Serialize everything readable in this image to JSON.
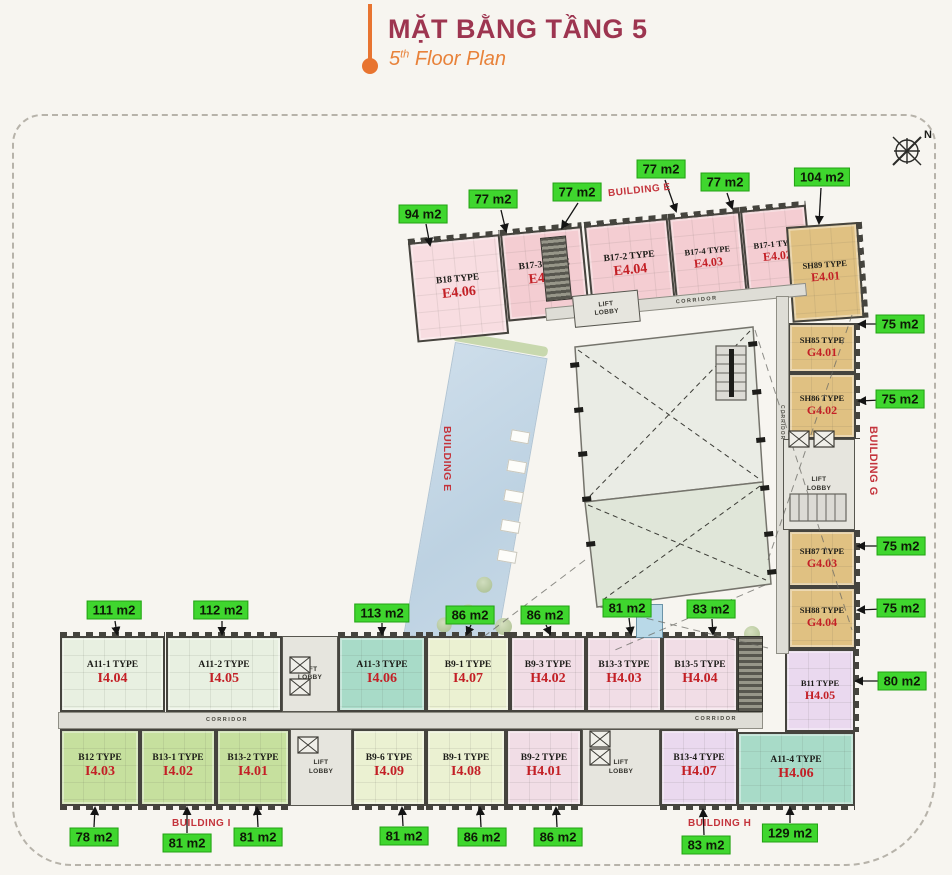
{
  "header": {
    "title": "MẶT BẰNG TẦNG 5",
    "subtitle_number": "5",
    "subtitle_ordinal": "th",
    "subtitle_text": " Floor Plan"
  },
  "compass": {
    "north_label": "N"
  },
  "labels": {
    "corridor": "CORRIDOR",
    "lift_lobby": "LIFT LOBBY",
    "building_e": "BUILDING E",
    "building_g": "BUILDING G",
    "building_h": "BUILDING H",
    "building_i": "BUILDING I"
  },
  "palette": {
    "pink": "#f4cdd2",
    "pink_light": "#f8dde1",
    "tan": "#e0c182",
    "pale_green": "#e8f0e1",
    "teal": "#a8dbc8",
    "sage": "#ebf1d2",
    "lime": "#c6e09e",
    "lavender": "#f1dde6",
    "purple": "#ead9ef",
    "badge_green": "#3fd62e",
    "unit_code_red": "#c32026",
    "building_label_red": "#c4343c",
    "title_maroon": "#9d3550",
    "accent_orange": "#e87430"
  },
  "units": [
    {
      "id": "E4.06",
      "name": "B18 TYPE",
      "code": "E4.06",
      "area": "94 m2"
    },
    {
      "id": "E4.05",
      "name": "B17-3 TYPE",
      "code": "E4.05",
      "area": "77 m2"
    },
    {
      "id": "E4.04",
      "name": "B17-2 TYPE",
      "code": "E4.04",
      "area": "77 m2"
    },
    {
      "id": "E4.03",
      "name": "B17-4 TYPE",
      "code": "E4.03",
      "area": "77 m2"
    },
    {
      "id": "E4.02",
      "name": "B17-1 TYPE",
      "code": "E4.02",
      "area": "77 m2"
    },
    {
      "id": "E4.01",
      "name": "SH89 TYPE",
      "code": "E4.01",
      "area": "104 m2"
    },
    {
      "id": "G4.01",
      "name": "SH85 TYPE",
      "code": "G4.01",
      "area": "75 m2"
    },
    {
      "id": "G4.02",
      "name": "SH86 TYPE",
      "code": "G4.02",
      "area": "75 m2"
    },
    {
      "id": "G4.03",
      "name": "SH87 TYPE",
      "code": "G4.03",
      "area": "75 m2"
    },
    {
      "id": "G4.04",
      "name": "SH88 TYPE",
      "code": "G4.04",
      "area": "75 m2"
    },
    {
      "id": "H4.05",
      "name": "B11 TYPE",
      "code": "H4.05",
      "area": "80 m2"
    },
    {
      "id": "H4.06",
      "name": "A11-4 TYPE",
      "code": "H4.06",
      "area": "129 m2"
    },
    {
      "id": "I4.04",
      "name": "A11-1 TYPE",
      "code": "I4.04",
      "area": "111 m2"
    },
    {
      "id": "I4.05",
      "name": "A11-2 TYPE",
      "code": "I4.05",
      "area": "112 m2"
    },
    {
      "id": "I4.06",
      "name": "A11-3 TYPE",
      "code": "I4.06",
      "area": "113 m2"
    },
    {
      "id": "I4.07",
      "name": "B9-1 TYPE",
      "code": "I4.07",
      "area": "86 m2"
    },
    {
      "id": "H4.02",
      "name": "B9-3 TYPE",
      "code": "H4.02",
      "area": "86 m2"
    },
    {
      "id": "H4.03",
      "name": "B13-3 TYPE",
      "code": "H4.03",
      "area": "81 m2"
    },
    {
      "id": "H4.04",
      "name": "B13-5 TYPE",
      "code": "H4.04",
      "area": "83 m2"
    },
    {
      "id": "I4.03",
      "name": "B12 TYPE",
      "code": "I4.03",
      "area": "78 m2"
    },
    {
      "id": "I4.02",
      "name": "B13-1 TYPE",
      "code": "I4.02",
      "area": "81 m2"
    },
    {
      "id": "I4.01",
      "name": "B13-2 TYPE",
      "code": "I4.01",
      "area": "81 m2"
    },
    {
      "id": "I4.09",
      "name": "B9-6 TYPE",
      "code": "I4.09",
      "area": "81 m2"
    },
    {
      "id": "I4.08",
      "name": "B9-1 TYPE",
      "code": "I4.08",
      "area": "86 m2"
    },
    {
      "id": "H4.01",
      "name": "B9-2 TYPE",
      "code": "H4.01",
      "area": "86 m2"
    },
    {
      "id": "H4.07",
      "name": "B13-4 TYPE",
      "code": "H4.07",
      "area": "83 m2"
    }
  ]
}
